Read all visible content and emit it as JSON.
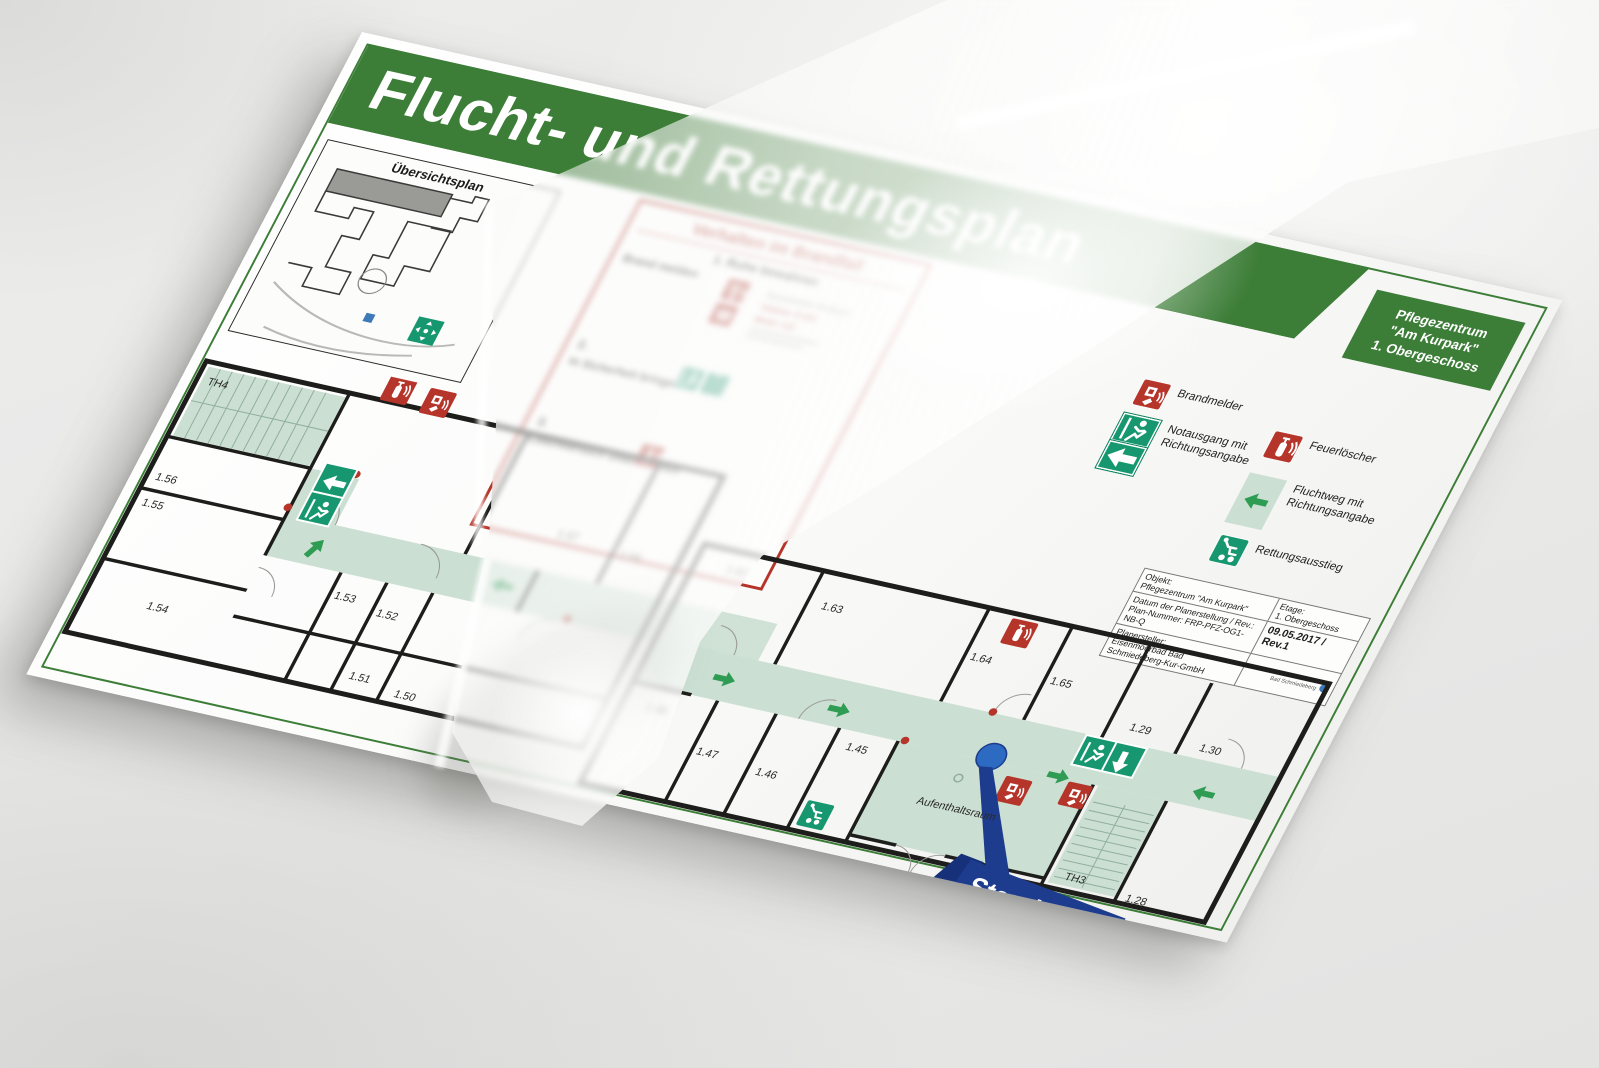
{
  "doc": {
    "title": "Flucht- und Rettungsplan",
    "location_box": {
      "line1": "Pflegezentrum",
      "line2": "\"Am Kurpark\"",
      "line3": "1. Obergeschoss"
    },
    "overview": {
      "title": "Übersichtsplan"
    },
    "fire": {
      "title": "Verhalten im Brandfall",
      "steps": [
        {
          "num": "1.",
          "headline": "Ruhe bewahren",
          "action": "Brand melden",
          "notes": [
            "Brandmelder betätigen",
            "Telefon: 0-112",
            "Mobil: 112"
          ]
        },
        {
          "num": "2.",
          "action": "In Sicherheit bringen"
        },
        {
          "num": "3.",
          "action": "Löschversuch unternehmen"
        }
      ]
    },
    "legend": {
      "items": [
        {
          "icon": "callpoint-icon",
          "label": "Brandmelder"
        },
        {
          "icon": "emergency-exit-icon",
          "label": "Notausgang mit Richtungsangabe"
        },
        {
          "icon": "fire-extinguisher-icon",
          "label": "Feuerlöscher"
        },
        {
          "icon": "escape-route-icon",
          "label": "Fluchtweg mit Richtungsangabe"
        },
        {
          "icon": "rescue-exit-icon",
          "label": "Rettungsausstieg"
        }
      ]
    },
    "info_table": {
      "objekt_label": "Objekt:",
      "objekt_value": "Pflegezentrum \"Am Kurpark\"",
      "etage_label": "Etage:",
      "etage_value": "1. Obergeschoss",
      "datum_label": "Datum der Planerstellung / Rev.:",
      "datum_value": "09.05.2017 / Rev.1",
      "plannr_label": "Plan-Nummer:",
      "plannr_value": "FRP-PFZ-OG1-NB-Q",
      "planersteller_label": "Planersteller:",
      "planersteller_value": "Eisenmoorbad Bad Schmiedeberg-Kur-GmbH",
      "logo_line1": "Eisenmoorbad",
      "logo_line2": "Bad Schmiedeberg"
    },
    "floorplan": {
      "standort_label": "Standort",
      "rooms": {
        "th4": "TH4",
        "r50": "1.50",
        "r51": "1.51",
        "r52": "1.52",
        "r53": "1.53",
        "r54": "1.54",
        "r55": "1.55",
        "r56": "1.56",
        "r57": "1.57",
        "r58": "1.58",
        "r62": "1.62",
        "r63": "1.63",
        "r64": "1.64",
        "r65": "1.65",
        "r45": "1.45",
        "r46": "1.46",
        "r47": "1.47",
        "r48": "1.48",
        "r29": "1.29",
        "r30": "1.30",
        "r28": "1.28",
        "th3": "TH3",
        "aufenthaltsraum": "Aufenthaltsraum"
      },
      "colors": {
        "banner_green": "#3c7d37",
        "safety_green": "#17976f",
        "route_green": "#cbdfd2",
        "arrow_green": "#2f9c53",
        "safety_red": "#b5352a",
        "standort_navy": "#1e3c8e",
        "dot_blue": "#2d6ac1",
        "wall_black": "#1d1d1b"
      }
    }
  }
}
